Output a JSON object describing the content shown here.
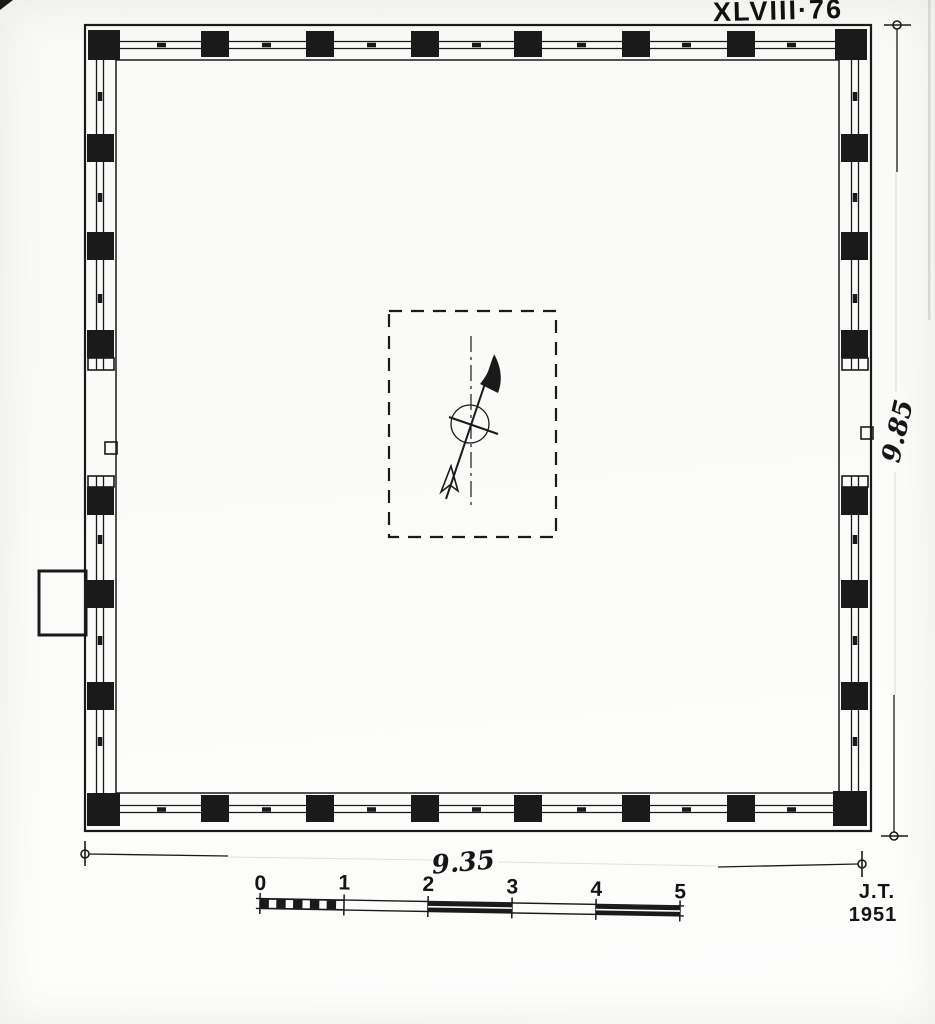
{
  "page": {
    "paper_color": "#fafaf8",
    "ink_color": "#1a1a1a"
  },
  "annotations": {
    "plate_number": "XLVIII·76",
    "width_dimension": "9.35",
    "height_dimension": "9.85",
    "signature": "J.T.",
    "year": "1951"
  },
  "scale_bar": {
    "unit_labels": [
      "0",
      "1",
      "2",
      "3",
      "4",
      "5"
    ]
  },
  "plan": {
    "columns_top": 8,
    "columns_bottom": 8,
    "columns_left": 8,
    "columns_right": 8
  },
  "icons": {
    "north_arrow": "north-arrow"
  }
}
